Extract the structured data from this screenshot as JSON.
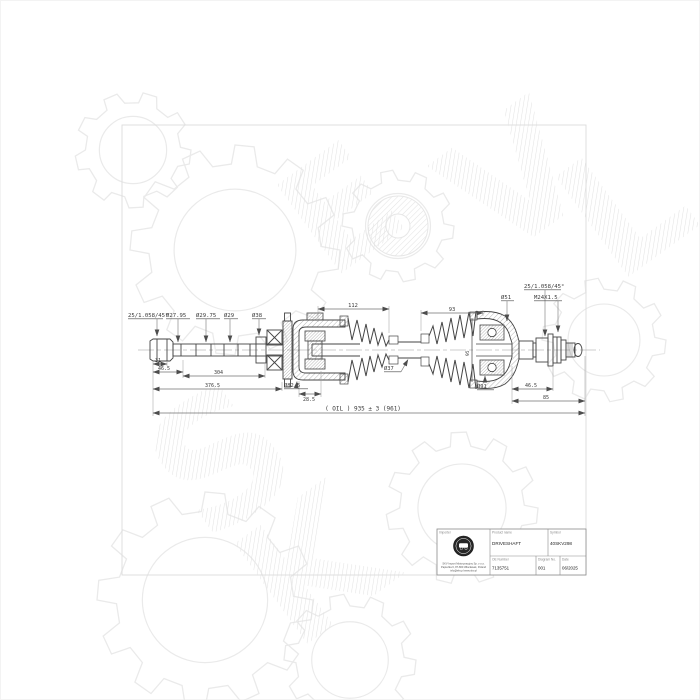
{
  "watermark": {
    "letters": [
      "E",
      "V",
      "L",
      "S",
      "K"
    ]
  },
  "labels": {
    "left_chamfer": "25/1.058/45°",
    "d2795": "Ø27.95",
    "d2975": "Ø29.75",
    "d29": "Ø29",
    "d38": "Ø38",
    "right_chamfer": "25/1.058/45°",
    "d51": "Ø51",
    "thread": "M24X1.5",
    "d825": "Ø82.5",
    "d37": "Ø37",
    "d91": "Ø91"
  },
  "dims": {
    "spline": "31",
    "left_seat": "46.5",
    "shaft": "304",
    "left_total": "376.5",
    "boot_left": "112",
    "boot_right": "93",
    "plunge": "28.5",
    "joint_side": "95",
    "right_seat": "46.5",
    "right_total": "85",
    "overall": "( OIL ) 935 ± 3 (961)"
  },
  "title_block": {
    "importer_label": "Importer",
    "product_name_label": "Product name",
    "product_name": "DRIVESHAFT",
    "symbol_label": "Symbol",
    "symbol": "40SKV298",
    "oe_number_label": "OE Number",
    "oe_number": "7135751",
    "diagram_no_label": "Diagram No.",
    "diagram_no": "001",
    "date_label": "Date",
    "date": "06/2025",
    "address_line1": "SKV Import Motoryzacyjny Sp. z o.o.",
    "address_line2": "Papieżka 6, 87-800 Włocławek, Poland",
    "address_line3": "info@skv.pl  www.skv.pl"
  }
}
